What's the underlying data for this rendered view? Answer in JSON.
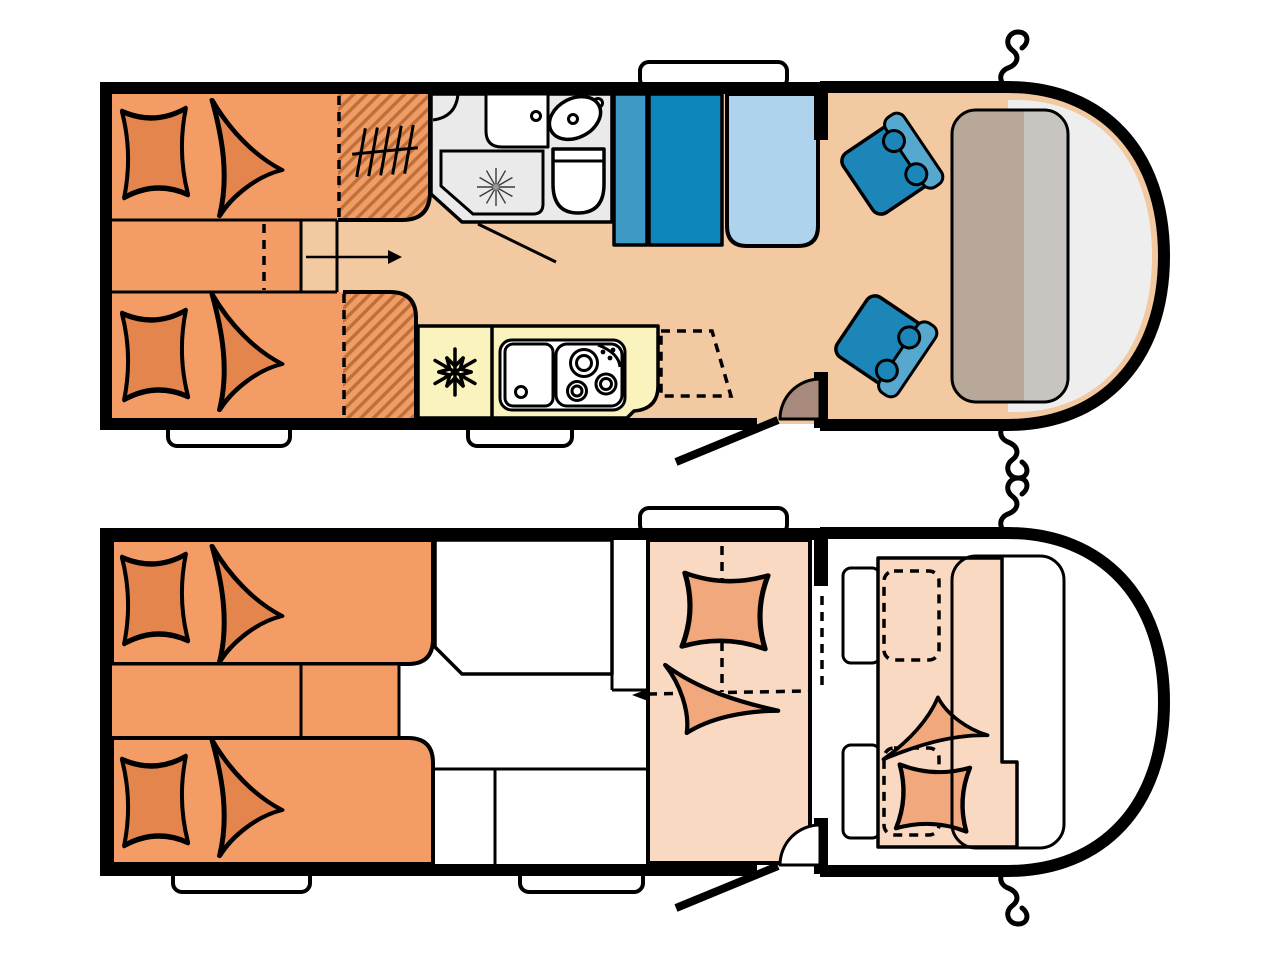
{
  "diagram": {
    "type": "motorhome-floorplan-diagram",
    "views": [
      {
        "id": "day-layout"
      },
      {
        "id": "night-layout"
      }
    ]
  },
  "colors": {
    "bg": "#FFFFFF",
    "wall": "#000000",
    "floor": "#F2C9A0",
    "bed": "#F49C66",
    "bedding": "#E5854E",
    "hatch-base": "#EE9D66",
    "hatch-stripe": "#C06F38",
    "yellow": "#FAF3BD",
    "yellow-stripe": "#E4D5A2",
    "bath": "#EAEAEA",
    "white": "#FFFFFF",
    "blue-dark": "#0E85BB",
    "blue-mid": "#3F99C5",
    "blue-light": "#AFD3EC",
    "seat-base": "#1D86B8",
    "seat-back": "#56A8CE",
    "dash-brown": "#B7A89A",
    "dash-grey": "#C8C4C0",
    "front-grey": "#EEEEEE",
    "door": "#A78A7B",
    "night-bed": "#FAD9C3",
    "night-bedding": "#F2A87D"
  },
  "icons": {
    "snowflake-icon": "fridge",
    "clothes-rail-icon": "wardrobe rail",
    "shower-drain-icon": "shower drain",
    "walkthrough-arrow-icon": "walk-through arrow",
    "fold-arrow-icon": "fold-down bed arrow",
    "side-mirror-icon": "side mirror"
  }
}
